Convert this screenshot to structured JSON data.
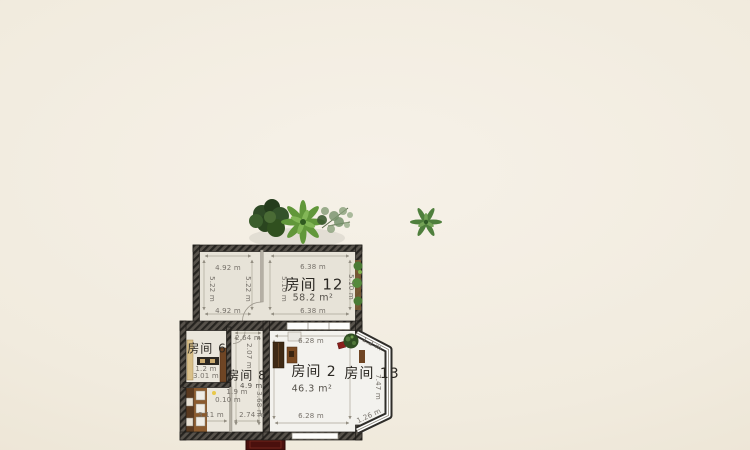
{
  "app": {
    "view": "2d-floor-plan-canvas"
  },
  "colors": {
    "background": "#f1ebde",
    "wall_dark": "#3a3631",
    "floor_room12": "#e7e3d8",
    "floor_room2": "#f3f2ee",
    "floor_left_block": "#eae6dc",
    "dim_text": "#76716a",
    "label_text": "#2b2823",
    "accent_plant_green": "#5a9433",
    "accent_red_furniture": "#5a1512"
  },
  "rooms": {
    "r12": {
      "label": "房间 12",
      "area": "58.2 m²"
    },
    "r6": {
      "label": "房间 6"
    },
    "r8": {
      "label": "房间 8",
      "area": "4.9 m²"
    },
    "r2": {
      "label": "房间 2",
      "area": "46.3 m²"
    },
    "r13": {
      "label": "房间 13"
    }
  },
  "dims": {
    "r12l_top": "4.92 m",
    "r12l_bottom": "4.92 m",
    "r12l_left": "5.22 m",
    "r12l_right": "5.22 m",
    "r12r_top": "6.38 m",
    "r12r_bottom": "6.38 m",
    "r12r_left": "5.10 m",
    "r12r_right": "5.10 m",
    "r6_width": "1.2 m",
    "r6_height": "3.01 m",
    "r8_top": "2.64 m",
    "r8_side": "2.07 m",
    "r8_door": "1.9 m",
    "r8_gap": "0.10 m",
    "kitchen_bottom_left": "3.11 m",
    "kitchen_bottom_right": "2.74 m",
    "kitchen_side": "3.68 m",
    "r2_top": "6.28 m",
    "r2_bottom": "6.28 m",
    "r13_side": "7.47 m",
    "r13_top": "1.2 m",
    "r13_bottom": "1.26 m"
  },
  "objects": {
    "plants": [
      "bush-plant",
      "palm-plant",
      "dry-shrub-plant",
      "small-tree",
      "potted-plant-room2",
      "wall-vine"
    ],
    "furniture": [
      "bench-room6",
      "wardrobe-room6",
      "kitchen-counter",
      "kitchen-appliances",
      "wardrobe-room2",
      "cabinet-room2",
      "dresser-room2",
      "red-chair",
      "red-sideboard"
    ]
  }
}
